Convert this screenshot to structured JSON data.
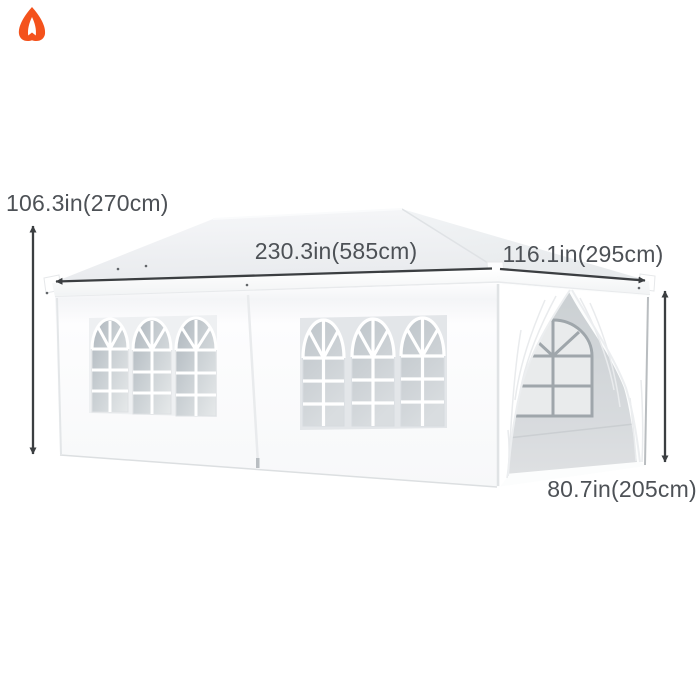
{
  "canvas": {
    "width": 700,
    "height": 700,
    "background": "#ffffff"
  },
  "brand": {
    "logo_icon": "flame-logo",
    "logo_color": "#f4521c"
  },
  "annotations": {
    "text_color": "#4d5156",
    "line_color": "#3b3e41",
    "labels": {
      "height": "106.3in(270cm)",
      "length": "230.3in(585cm)",
      "depth": "116.1in(295cm)",
      "side_height": "80.7in(205cm)"
    }
  },
  "product": {
    "name": "white pop-up gazebo tent with sidewalls",
    "canopy_color": "#eceef1",
    "wall_color": "#fcfdfe",
    "window_pane_color": "#c7cdd2",
    "interior_color": "#d6d9db",
    "left_panel_windows": 3,
    "front_panel_windows": 3,
    "doorway": "open end with tied-back curtains"
  }
}
